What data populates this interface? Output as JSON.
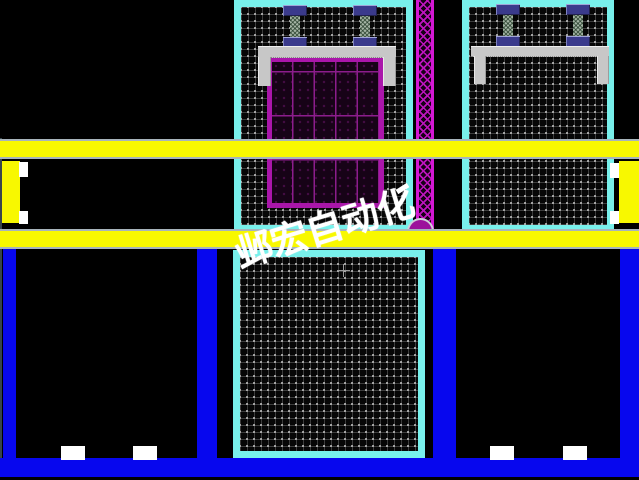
{
  "watermark": {
    "text": "邺宏自动化",
    "color": "#ffffff"
  },
  "cursor": {
    "type": "crosshair",
    "x": 343,
    "y": 270
  },
  "palette": {
    "background": "#000000",
    "conveyor_rail_yellow": "#f8f800",
    "base_frame_blue": "#0707ee",
    "station_border_cyan": "#78f0eb",
    "pallet_border_magenta": "#aa16aa",
    "lattice_column_magenta": "#d418d4",
    "clamp_navy": "#3a3a8c",
    "bracket_gray": "#c7c7c7",
    "foot_white": "#ffffff"
  },
  "drawing": {
    "pallet_grid": {
      "columns": 5,
      "rows": 3
    },
    "stations": [
      {
        "name": "top-center-station",
        "contents": "two clamps, lift bracket, magenta pallet grid"
      },
      {
        "name": "top-right-station",
        "contents": "two clamps, lift bracket (empty, no pallet)"
      },
      {
        "name": "bottom-center-station",
        "contents": "empty hatch bin"
      },
      {
        "name": "bottom-left-bin",
        "contents": "black bin with two white feet"
      },
      {
        "name": "bottom-right-bin",
        "contents": "black bin with two white feet"
      }
    ],
    "rails": [
      {
        "name": "upper-yellow-rail"
      },
      {
        "name": "lower-yellow-rail"
      },
      {
        "name": "bottom-blue-frame"
      }
    ]
  }
}
